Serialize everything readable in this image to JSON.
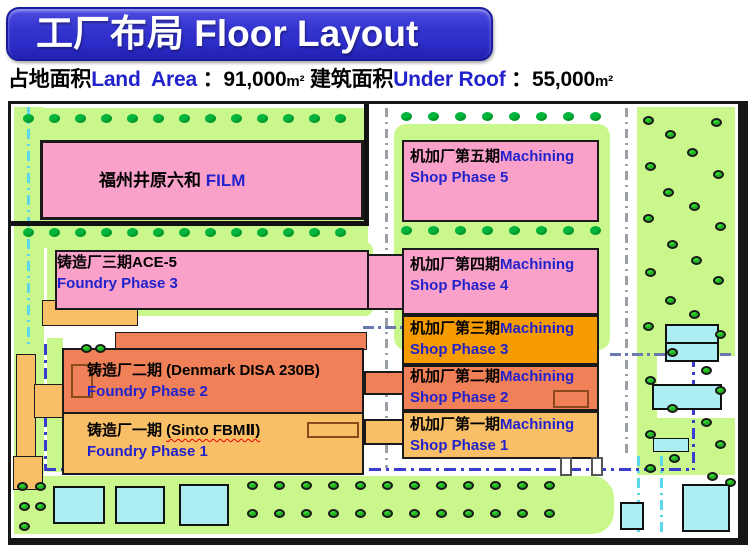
{
  "title": "工厂布局 Floor Layout",
  "subtitle": {
    "segments": [
      {
        "text": "占地面积"
      },
      {
        "text": "Land  Area"
      },
      {
        "text": " ：91,000"
      },
      {
        "text": "m²"
      },
      {
        "text": " 建筑面积"
      },
      {
        "text": "Under Roof"
      },
      {
        "text": " ：55,000"
      },
      {
        "text": "m²"
      }
    ]
  },
  "map": {
    "buildings": {
      "film": {
        "cn": "福州井原六和 ",
        "en": "FILM"
      },
      "foundry3": {
        "cn": "铸造厂三期ACE-5",
        "en": "Foundry Phase 3"
      },
      "foundry2": {
        "cn": "铸造厂二期 (Denmark DISA 230B)",
        "en": "Foundry Phase 2"
      },
      "foundry1": {
        "cn": "铸造厂一期 ",
        "cn2": "(Sinto FBMⅡ)",
        "en": "Foundry Phase 1"
      },
      "mach5": {
        "cn": "机加厂第五期",
        "en1": "Machining",
        "en2": "Shop Phase 5"
      },
      "mach4": {
        "cn": "机加厂第四期",
        "en1": "Machining",
        "en2": "Shop Phase 4"
      },
      "mach3": {
        "cn": "机加厂第三期",
        "en1": "Machining",
        "en2": "Shop Phase 3"
      },
      "mach2": {
        "cn": "机加厂第二期",
        "en1": "Machining",
        "en2": "Shop Phase 2"
      },
      "mach1": {
        "cn": "机加厂第一期",
        "en1": "Machining",
        "en2": "Shop Phase 1"
      }
    }
  },
  "colors": {
    "banner_blue": "#2c2cc8",
    "banner_border": "#1b1b9e",
    "text_blue": "#2222cc",
    "pink": "#f9a1c8",
    "coral": "#ef8057",
    "light_orange": "#f9bf67",
    "orange": "#f79c00",
    "green": "#c9f78c",
    "tree_dark": "#00b43c",
    "tree_bright": "#2ed32e",
    "cyan_building": "#aceef2"
  },
  "icons": {
    "tree": "tree-icon"
  }
}
